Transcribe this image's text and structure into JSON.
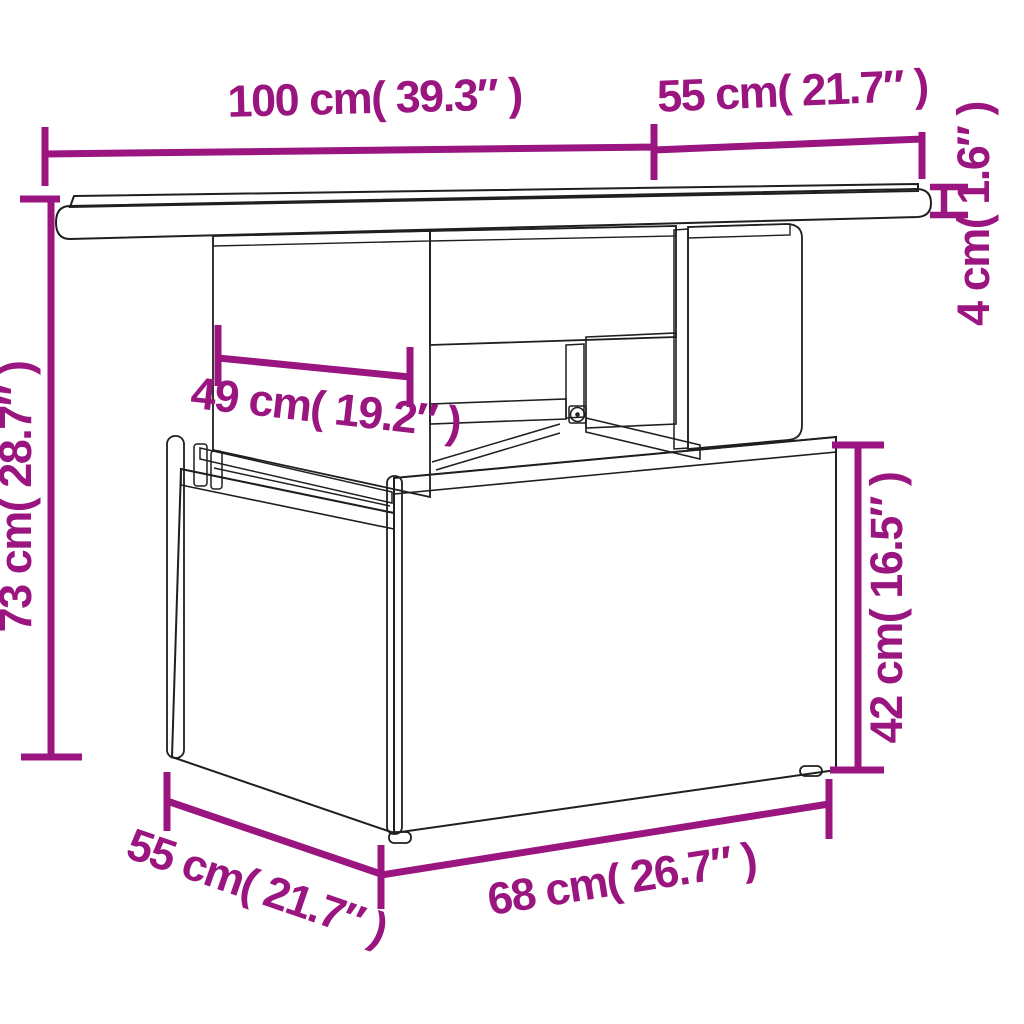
{
  "colors": {
    "accent": "#9A1580",
    "line_art": "#1f1f1f",
    "tabletop_surface": "#3d3d3d",
    "background": "#ffffff"
  },
  "diagram": {
    "subject": "rattan-garden-table-dimension-drawing",
    "labels": {
      "top_width": "100 cm( 39.3″ )",
      "top_depth": "55 cm( 21.7″ )",
      "tabletop_thickness": "4 cm( 1.6″ )",
      "total_height": "73 cm( 28.7″ )",
      "pedestal_width": "49 cm( 19.2″ )",
      "base_height": "42 cm( 16.5″ )",
      "base_width": "68 cm( 26.7″ )",
      "base_depth": "55 cm( 21.7″ )"
    }
  }
}
